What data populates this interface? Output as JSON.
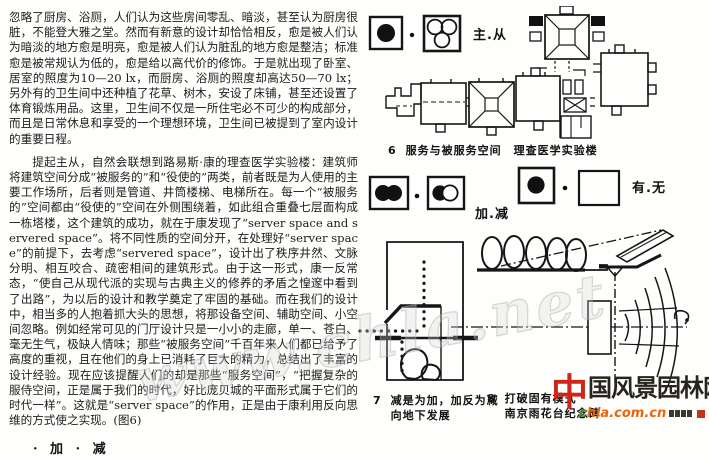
{
  "article": {
    "para1": "忽略了厨房、浴厕，人们认为这些房间零乱、暗淡，甚至认为厨房很脏，不能登大雅之堂。然而有新意的设计却恰恰相反，愈是被人们认为暗淡的地方愈是明亮，愈是被人们认为脏乱的地方愈是整洁；标准愈是被常规认为低的，愈是给以高代价的修饰。于是就出现了卧室、居室的照度为10—20 lx，而厨房、浴厕的照度却高达50—70 lx；另外有的卫生间中还种植了花草、树木，安设了床铺，甚至还设置了体育锻炼用品。这里，卫生间不仅是一所住宅必不可少的构成部分，而且是日常休息和享受的一个理想环境，卫生间已被提到了室内设计的重要日程。",
    "para2": "提起主从，自然会联想到路易斯·康的理查医学实验楼：建筑师将建筑空间分成“被服务的”和“役使的”两类，前者既是为人使用的主要工作场所，后者则是管道、井筒楼梯、电梯所在。每一个“被服务的”空间都由“役使的”空间在外侧围绕着，如此组合重叠七层面构成一栋塔楼，这个建筑的成功，就在于康发现了“server space and servered space”。将不同性质的空间分开，在处理好“server space”的前提下，去考虑“servered space”，设计出了秩序井然、文脉分明、相互咬合、疏密相间的建筑形式。由于这一形式，康一反常态，“使自己从现代派的实现与古典主义的修养的矛盾之惶邃中看到了出路”，为以后的设计和教学奠定了牢固的基础。而在我们的设计中，相当多的人抱着抓大头的思想，将那设备空间、辅助空间、小空间忽略。例如经常可见的门厅设计只是一小小的走廊，单一、苍白、毫无生气，极缺人情味；那些“被服务空间”千百年来人们都已给予了高度的重视，且在他们的身上已消耗了巨大的精力，总结出了丰富的设计经验。现在应该提醒人们的却是那些“服务空间”，“把握复杂的服侍空间，正是属于我们的时代，好比庞贝城的平面形式属于它们的时代一样”。这就是“server space”的作用，正是由于康利用反向思维的方式使之实现。(图6)",
    "section_heading": "· 加 · 减"
  },
  "figures": {
    "fig6": {
      "number": "6",
      "caption": "服务与被服务空间　理查医学实验楼"
    },
    "fig7": {
      "number": "7",
      "line1": "减是为加，加反为减",
      "line2": "向地下发展"
    },
    "fig8": {
      "number": "8",
      "line1": "打破固有模式",
      "line2": "南京雨花台纪念碑"
    }
  },
  "legends": {
    "main_sub": {
      "label": "主.从",
      "icon_left": "solid-circle-box-icon",
      "icon_right": "three-circles-box-icon"
    },
    "add_sub": {
      "label": "加.减",
      "icon_left": "merged-circles-box-icon",
      "icon_right": "overlapping-circles-box-icon"
    },
    "have_none": {
      "label": "有.无",
      "icon_left": "solid-circle-box-icon",
      "icon_right": "empty-box-icon"
    }
  },
  "watermark": {
    "diagonal_text": "www.chla.net",
    "logo_first_char": "中",
    "logo_rest": "国风景园林网",
    "logo_url": "chla.com.cn"
  },
  "colors": {
    "ink": "#1b1b1b",
    "logo_red": "#cf2717",
    "logo_orange": "#e8650e",
    "logo_green": "#4a8c22",
    "watermark_gray": "#c9c9c9"
  }
}
